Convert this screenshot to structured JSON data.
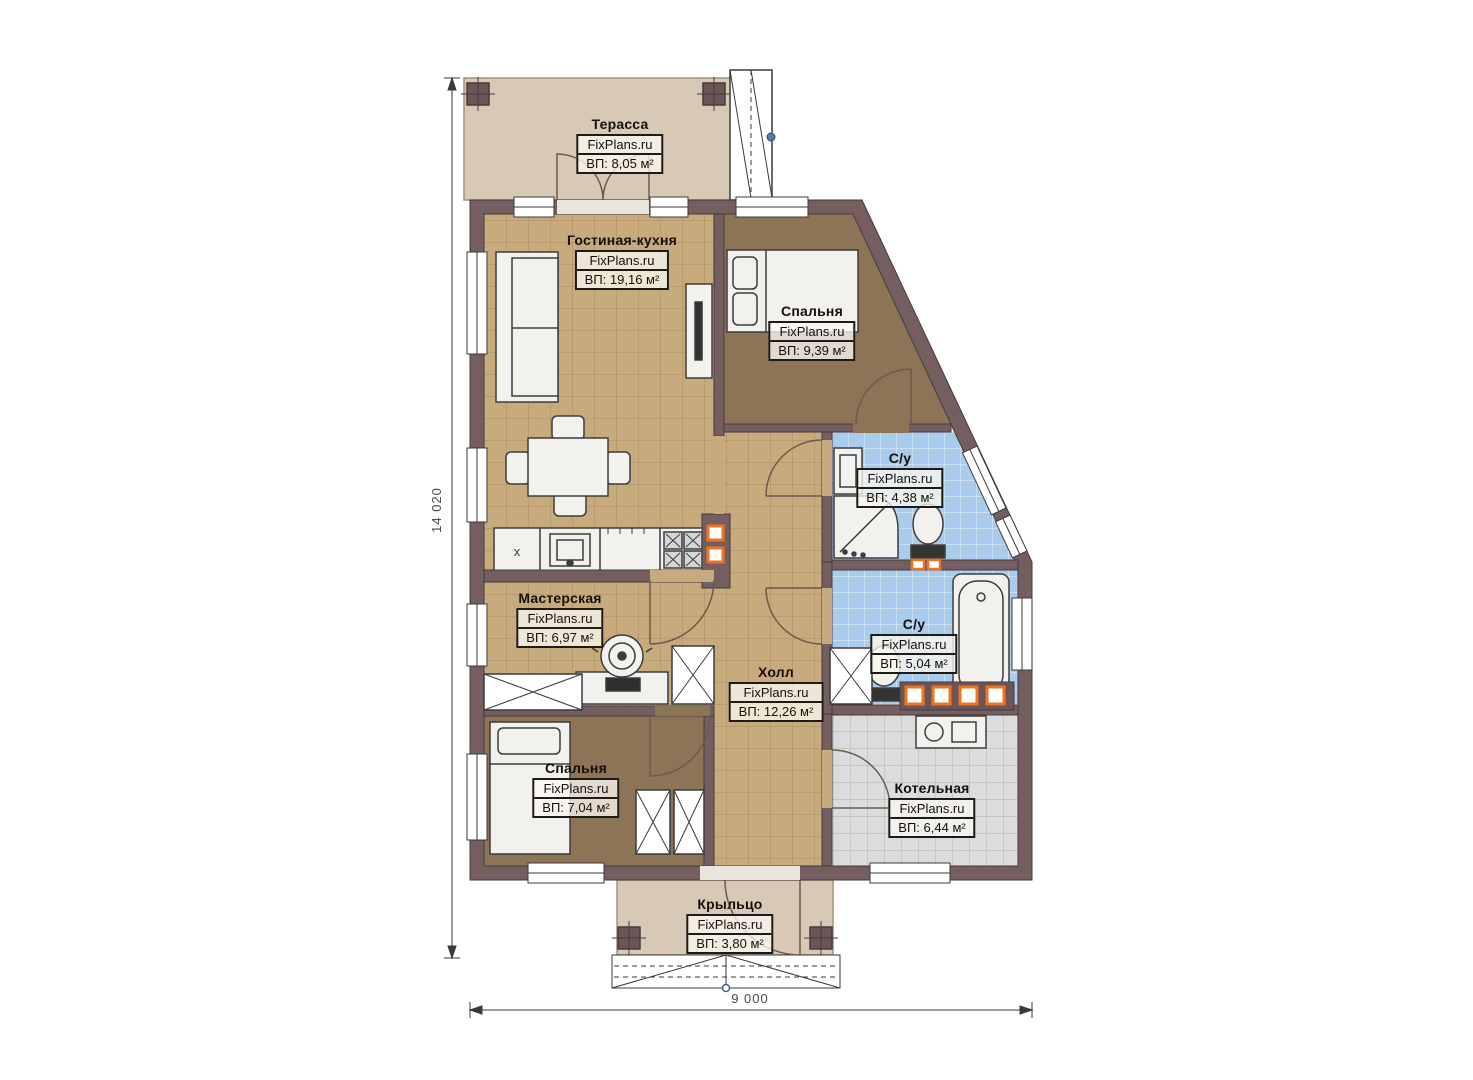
{
  "plan": {
    "brand": "FixPlans.ru",
    "rooms": [
      {
        "id": "terrace",
        "name": "Терасса",
        "area": "ВП: 8,05 м²"
      },
      {
        "id": "living-kitchen",
        "name": "Гостиная-кухня",
        "area": "ВП: 19,16 м²"
      },
      {
        "id": "bedroom-top",
        "name": "Спальня",
        "area": "ВП: 9,39 м²"
      },
      {
        "id": "bathroom-top",
        "name": "С/у",
        "area": "ВП: 4,38 м²"
      },
      {
        "id": "workshop",
        "name": "Мастерская",
        "area": "ВП: 6,97 м²"
      },
      {
        "id": "hall",
        "name": "Холл",
        "area": "ВП: 12,26 м²"
      },
      {
        "id": "bathroom-bottom",
        "name": "С/у",
        "area": "ВП: 5,04 м²"
      },
      {
        "id": "bedroom-bottom",
        "name": "Спальня",
        "area": "ВП: 7,04 м²"
      },
      {
        "id": "boiler-room",
        "name": "Котельная",
        "area": "ВП: 6,44 м²"
      },
      {
        "id": "porch",
        "name": "Крыльцо",
        "area": "ВП: 3,80 м²"
      }
    ],
    "dimensions": {
      "vertical": "14 020",
      "horizontal": "9 000"
    },
    "kitchen_mark": "x",
    "colors": {
      "wall": "#745e60",
      "floor_tan": "#c7ab7d",
      "floor_brown": "#8d7457",
      "floor_blue": "#a9cbec",
      "floor_grey": "#dcdcdc",
      "floor_beige": "#d8c9b7",
      "accent_orange": "#ee7420"
    }
  }
}
